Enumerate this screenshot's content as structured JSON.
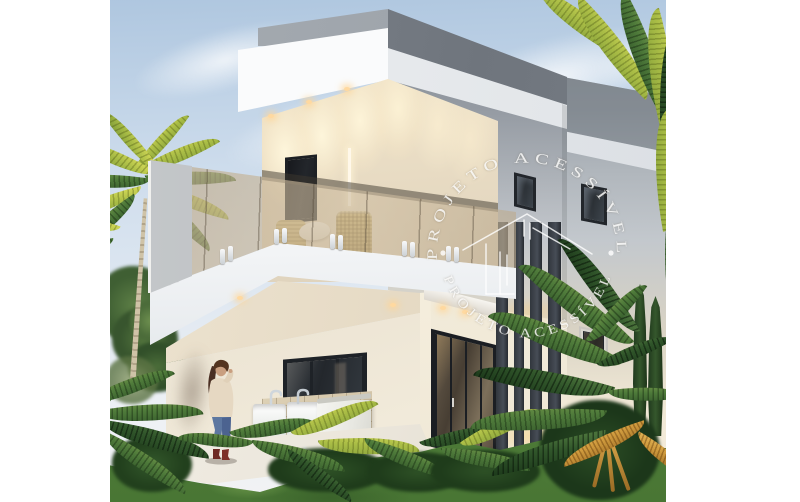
{
  "scene": {
    "description_label": "3D architectural rendering of a modern two-story house with palm trees, garden, balcony and laundry patio"
  },
  "watermark": {
    "arc_text_top": "PROJETO ACESSÍVEL",
    "arc_text_bottom": "PROJETO ACESSÍVEL",
    "icon": "house-outline-icon",
    "separator": "dot-icon",
    "color": "#ffffff"
  },
  "palette": {
    "sky_top": "#aec6df",
    "sky_bottom": "#f2f3f4",
    "wall_white": "#f8f9fa",
    "wall_gray": "#9aa1a8",
    "wall_cream": "#ecdfc6",
    "glass_bronze": "#b6a284",
    "frame_dark": "#22262b",
    "grass_green": "#558540",
    "foliage_dark": "#2c4f26",
    "foliage_light": "#ccd454",
    "warm_light": "#ffd9a0",
    "jeans_blue": "#5d77a0",
    "border_white": "#ffffff"
  }
}
